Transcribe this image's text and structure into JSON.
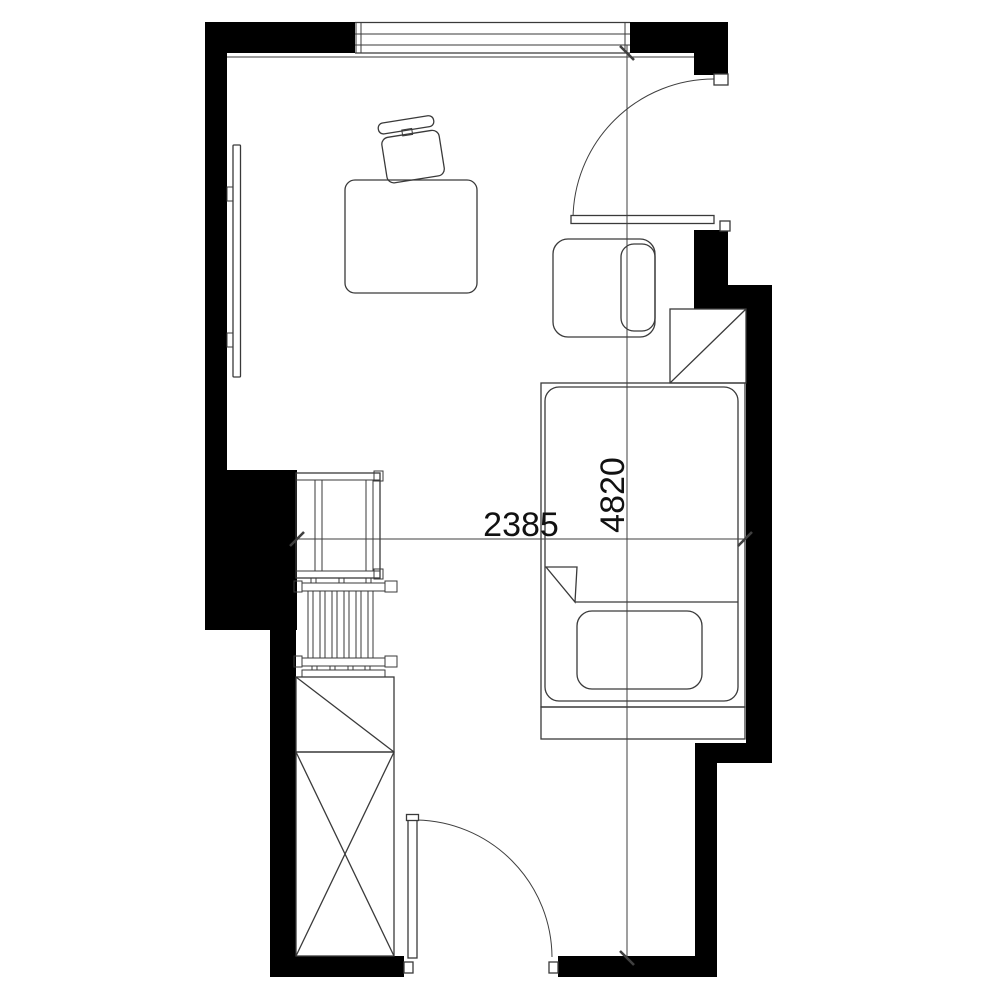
{
  "plan": {
    "title": "apartment-room-floor-plan",
    "dimension_labels": {
      "width": "2385",
      "height": "4820"
    },
    "colors": {
      "wall": "#000000",
      "line": "#3a3a3a",
      "dim": "#3f3f3f",
      "text": "#111111",
      "background": "#ffffff"
    },
    "openings": [
      "window-top",
      "door-right",
      "door-bottom"
    ],
    "furniture": [
      "wall-tv-panel",
      "desk",
      "desk-chair",
      "armchair",
      "corner-shelf",
      "bed",
      "pillow",
      "side-table",
      "radiator",
      "cabinet",
      "wardrobe"
    ]
  }
}
